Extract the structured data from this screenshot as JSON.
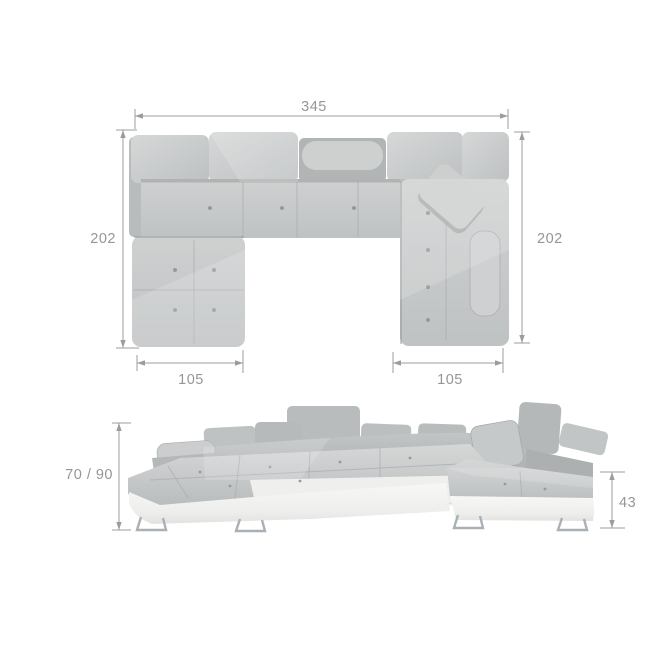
{
  "product": {
    "type": "u-shaped-corner-sofa",
    "views": {
      "top_view_name": "top-view",
      "front_view_name": "front-view"
    }
  },
  "dimensions": {
    "top_view": {
      "total_width": "345",
      "left_side_depth": "202",
      "right_side_depth": "202",
      "left_chaise_width": "105",
      "right_chaise_width": "105"
    },
    "front_view": {
      "seat_backrest_height": "70 / 90",
      "base_height": "43"
    }
  },
  "colors": {
    "background": "#ffffff",
    "dimension_line": "#9c9c9c",
    "dimension_text": "#969696",
    "fabric_light": "#d2d4d4",
    "fabric_mid": "#c6c8c9",
    "fabric_dark": "#b1b4b5",
    "base_white": "#f4f4f3",
    "chrome_leg": "#a9b1b6"
  }
}
